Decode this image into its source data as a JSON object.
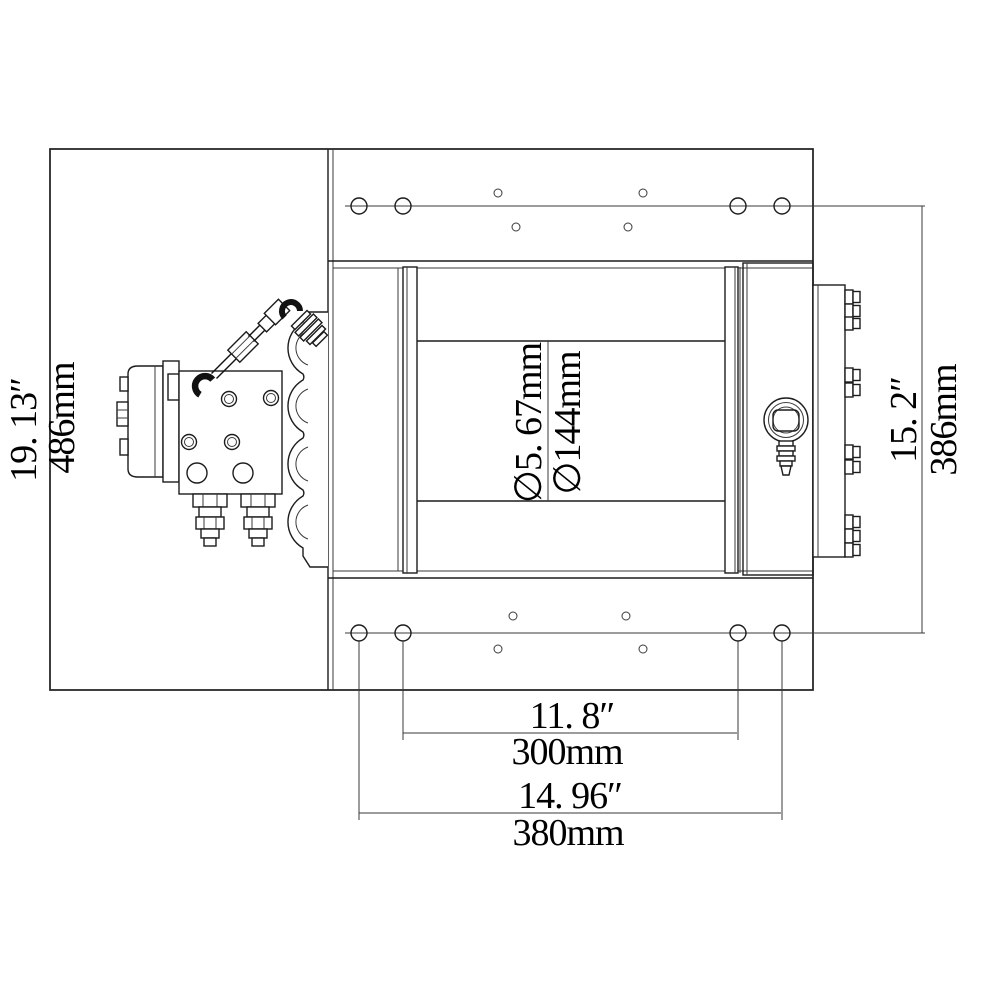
{
  "drawing_title": "hydraulic-winch-dimension-drawing",
  "colors": {
    "line": "#1c1c1c",
    "background": "#ffffff",
    "text": "#000000"
  },
  "dims": {
    "frame_height": {
      "inch": "19. 13″",
      "mm": "486mm"
    },
    "mount_span": {
      "inch": "15. 2″",
      "mm": "386mm"
    },
    "drum_diameter": {
      "inch_label": "∅5. 67mm",
      "mm_label": "∅144mm"
    },
    "bolt_inner": {
      "inch": "11. 8″",
      "mm": "300mm"
    },
    "bolt_outer": {
      "inch": "14. 96″",
      "mm": "380mm"
    }
  }
}
